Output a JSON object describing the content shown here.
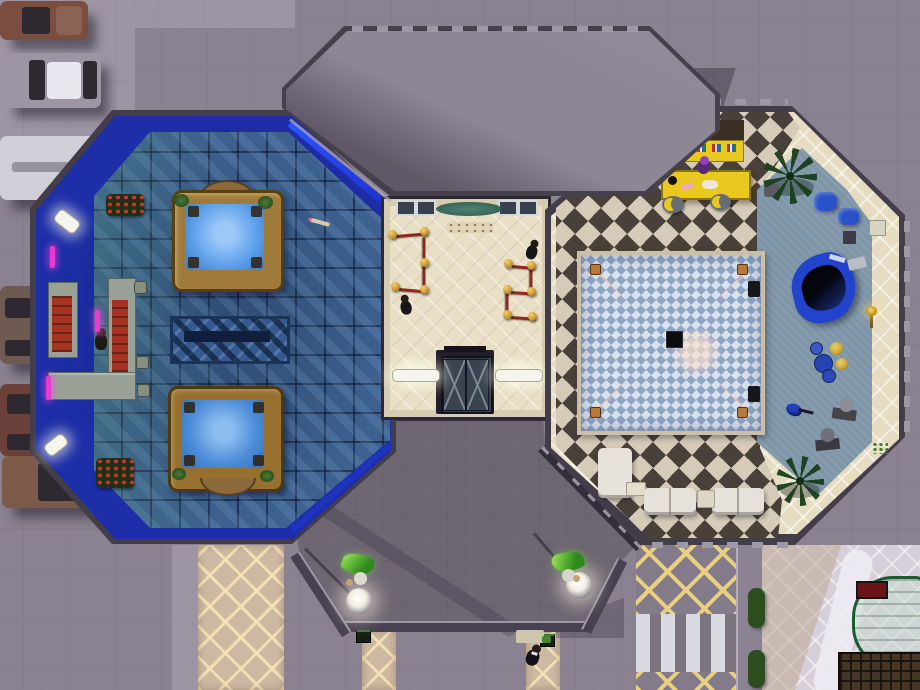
{
  "meta": {
    "style": "life-simulation game, overhead top-down lot view of a nightclub venue",
    "time_of_day": "evening",
    "hud_text_visible": false
  },
  "palette": {
    "pavement": "#8a8191",
    "sidewalk": "#9d95a4",
    "porch": "#6e6673",
    "roof": "#8e8595",
    "wall_dark": "#433d4a",
    "trim_light": "#9d97a6",
    "carpet_blue": "#1d2ea8",
    "tile_blue": "#3e618f",
    "floor_cream": "#e8dfc6",
    "wall_cream": "#d5ccb2",
    "checker_dark": "#49403a",
    "checker_light": "#d6cbb8",
    "dance_blue": "#8fa6c4",
    "dance_light": "#dae2ed",
    "carpet_gray": "#7e96a8",
    "club_cream": "#e6dcc2",
    "bar_red": "#a63222",
    "counter_gray": "#9aa298",
    "bar_yellow": "#e9c91f",
    "tub_wood": "#a07a3a",
    "water": "#5ea0ea",
    "rope_red": "#8c2a22",
    "stanchion_gold": "#c9972f",
    "plumbob_green": "#5fd32e",
    "neon_magenta": "#e83ad0",
    "walkway_tan": "#cdb9a2",
    "lattice_yellow": "#e8d080",
    "plaza": "#d6cfd9",
    "hedge": "#2c4d1d",
    "shelter_green": "#1a5c30",
    "sign_red": "#6a1418",
    "piano_blue": "#2244cc",
    "sofa_white": "#e6e2da",
    "road": "#837b89",
    "crosswalk": "#d9d9e2"
  },
  "labels": {
    "hot_tub": "Hot tub",
    "rug": "Patterned rug",
    "spa_bar": "Bar",
    "bar_stool": "Bar stool",
    "bartender": "Bartender sim",
    "bouncer": "Bouncer sim",
    "elevator": "Elevator",
    "velvet_rope": "Velvet rope queue",
    "dance_floor": "Dance floor",
    "club_bar": "Bar",
    "piano": "Grand piano",
    "drums": "Drum kit",
    "bass": "Bass guitar",
    "statue": "Statue",
    "armchair": "Armchair",
    "sofa": "Sofa",
    "end_table": "End table",
    "coffee_table": "Coffee table",
    "ball_lamp": "Ball lamp",
    "greeter": "Sim with plumbob",
    "doorman": "Doorman sim",
    "speaker": "Speaker",
    "palm": "Palm plant",
    "bench": "Piano bench"
  },
  "scene": {
    "rooms": [
      {
        "id": "spa-lounge",
        "position": "west octagon",
        "floor": "blue mosaic tile with royal-blue carpet border and neon wall glow",
        "objects": [
          "two hot tubs with wood frames",
          "patterned blue rug",
          "L-shaped bar with red tops",
          "three bar stools",
          "bartender sim",
          "three magenta neon sconces",
          "two angled wall lights",
          "two red flower planters",
          "pool cue on floor"
        ]
      },
      {
        "id": "entry-hall",
        "position": "center corridor",
        "floor": "cream lattice tile",
        "objects": [
          "two velvet-rope queues with gold stanchions",
          "two dark-suited bouncer sims",
          "elevator with cross-braced doors",
          "two fluorescent wall lights",
          "two windows",
          "garland wall decoration",
          "door mat"
        ]
      },
      {
        "id": "dance-club",
        "position": "east octagon",
        "floor": "brown/cream diamond checker, blue-gray carpet, cream walkway",
        "objects": [
          "blue checkered dance floor with four corner spotlights and center speaker",
          "yellow bar with bottle shelf",
          "bartender sim",
          "two crescent bar stools",
          "two palm plants",
          "blue grand piano with bench",
          "drum kit with gold cymbals",
          "blue bass guitar",
          "three statues",
          "two blue armchairs",
          "two white sofas and white armchair",
          "end table",
          "coffee table",
          "two edge speakers",
          "gold wall lamp"
        ]
      }
    ],
    "exterior": {
      "canopy": "large octagonal porte-cochere roof at north",
      "porch": "dark entrance terrace at south with two glowing ball lamps and two greeter sims with green plumbobs",
      "walkways": "tan lattice paths: one long at southwest, two short below porch",
      "street_west": "six parked vehicles along west edge",
      "southeast": "yellow lattice road markings, zebra crosswalk, curb strip, two hedges, green-framed glass bus shelter, red sign, dark trellis, cream plaza with curved light path"
    }
  },
  "counts": {
    "vehicles": 6,
    "sims_visible": 7,
    "hot_tubs": 2,
    "ball_lamps": 2,
    "stanchions": 11,
    "sofas": 3
  }
}
